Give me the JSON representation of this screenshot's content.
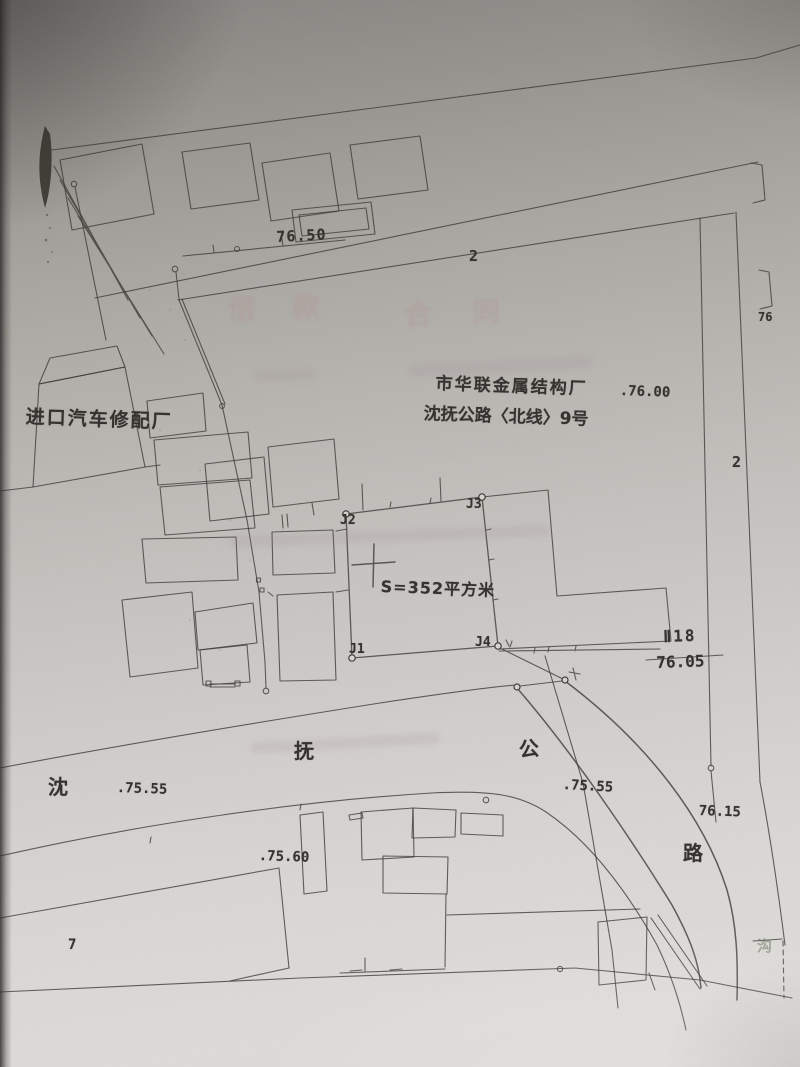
{
  "map": {
    "labels": {
      "elev_7650": "76.50",
      "parcel_top": "2",
      "factory_name": "市华联金属结构厂",
      "factory_address": "沈抚公路〈北线〉9号",
      "elev_7600": ".76.00",
      "repair_factory": "进口汽车修配厂",
      "j1": "J1",
      "j2": "J2",
      "j3": "J3",
      "j4": "J4",
      "area": "S=352平方米",
      "benchmark_id": "Ⅱ18",
      "benchmark_elev": "76.05",
      "parcel_right": "2",
      "elev_76_partial": "76",
      "road_char_1": "沈",
      "road_char_2": "抚",
      "road_char_3": "公",
      "road_char_4": "路",
      "elev_7555_w": ".75.55",
      "elev_7555_e": ".75.55",
      "elev_7615": "76.15",
      "elev_7560": ".75.60",
      "parcel_sw": "7",
      "ditch": "沟"
    },
    "bleedthrough": {
      "word_1": "借款",
      "word_2": "合同"
    },
    "colors": {
      "ink": "#3f3d39",
      "paper_light": "#e0dedа",
      "paper_dark": "#8a8884",
      "bleed": "#b08a8a"
    }
  }
}
